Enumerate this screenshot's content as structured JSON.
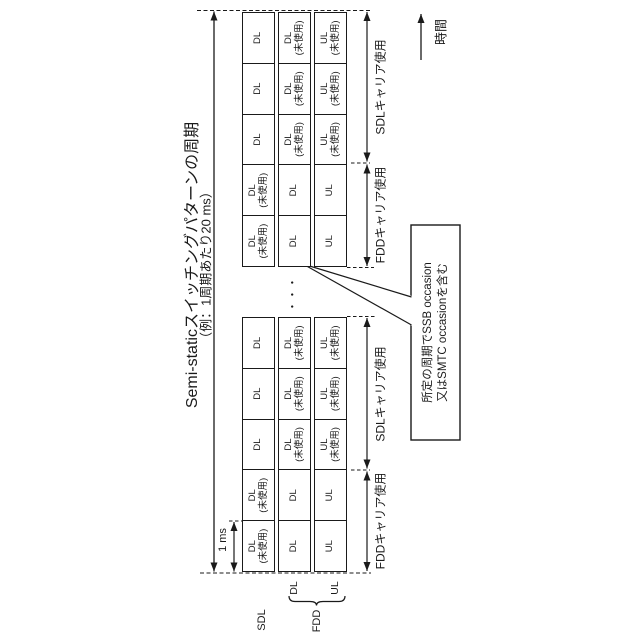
{
  "figure": {
    "title_line1": "Semi-staticスイッチングパターンの周期",
    "title_line2": "（例：1周期あたり20 ms）",
    "slot_duration_label": "1 ms",
    "time_axis_label": "時間",
    "ellipsis": "・・・",
    "callout": {
      "line1": "所定の周期でSSB occasion",
      "line2": "又はSMTC occasionを含む"
    }
  },
  "legend": {
    "sdl_row": "SDL",
    "fdd_group": "FDD",
    "fdd_dl_row": "DL",
    "fdd_ul_row": "UL"
  },
  "carrier_usage": {
    "fdd": "FDDキャリア使用",
    "sdl": "SDLキャリア使用"
  },
  "groups": [
    {
      "rows": [
        {
          "name": "SDL DL row",
          "cells": [
            "DL\n(未使用)",
            "DL\n(未使用)",
            "DL",
            "DL",
            "DL"
          ]
        },
        {
          "name": "FDD DL row",
          "cells": [
            "DL",
            "DL",
            "DL\n(未使用)",
            "DL\n(未使用)",
            "DL\n(未使用)"
          ]
        },
        {
          "name": "FDD UL row",
          "cells": [
            "UL",
            "UL",
            "UL\n(未使用)",
            "UL\n(未使用)",
            "UL\n(未使用)"
          ]
        }
      ]
    },
    {
      "rows": [
        {
          "name": "SDL DL row",
          "cells": [
            "DL\n(未使用)",
            "DL\n(未使用)",
            "DL",
            "DL",
            "DL"
          ]
        },
        {
          "name": "FDD DL row",
          "cells": [
            "DL",
            "DL",
            "DL\n(未使用)",
            "DL\n(未使用)",
            "DL\n(未使用)"
          ]
        },
        {
          "name": "FDD UL row",
          "cells": [
            "UL",
            "UL",
            "UL\n(未使用)",
            "UL\n(未使用)",
            "UL\n(未使用)"
          ]
        }
      ]
    }
  ],
  "colors": {
    "ink": "#1a1a1a",
    "background": "#ffffff"
  }
}
